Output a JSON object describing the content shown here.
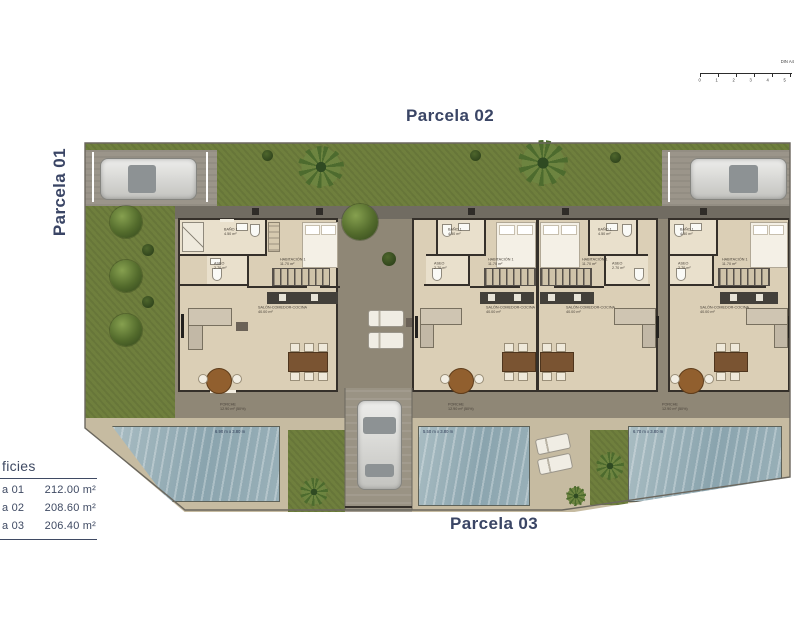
{
  "titles": {
    "parcela_01": "Parcela 01",
    "parcela_02": "Parcela 02",
    "parcela_03": "Parcela 03"
  },
  "scale_bar": {
    "label": "DIN A4",
    "ticks": [
      "0",
      "1",
      "2",
      "3",
      "4",
      "5"
    ]
  },
  "areas_table": {
    "header": "ficies",
    "rows": [
      {
        "label": "a 01",
        "value": "212.00 m²"
      },
      {
        "label": "a 02",
        "value": "208.60 m²"
      },
      {
        "label": "a 03",
        "value": "206.40 m²"
      }
    ]
  },
  "rooms": {
    "bano": {
      "name": "BAÑO 1",
      "area": "4.50 m²"
    },
    "aseo": {
      "name": "ASEO",
      "area": "2.70 m²"
    },
    "habitacion": {
      "name": "HABITACIÓN 1",
      "area": "11.70 m²"
    },
    "salon": {
      "name": "SALÓN-COMEDOR-COCINA",
      "area": "40.00 m²"
    },
    "porche": {
      "name": "PORCHE",
      "area": "12.90 m² (50%)"
    }
  },
  "pools": [
    {
      "dims": "6.90 m x 3.80 m"
    },
    {
      "dims": "5.50 m x 3.80 m"
    },
    {
      "dims": "6.70 m x 3.80 m"
    }
  ]
}
